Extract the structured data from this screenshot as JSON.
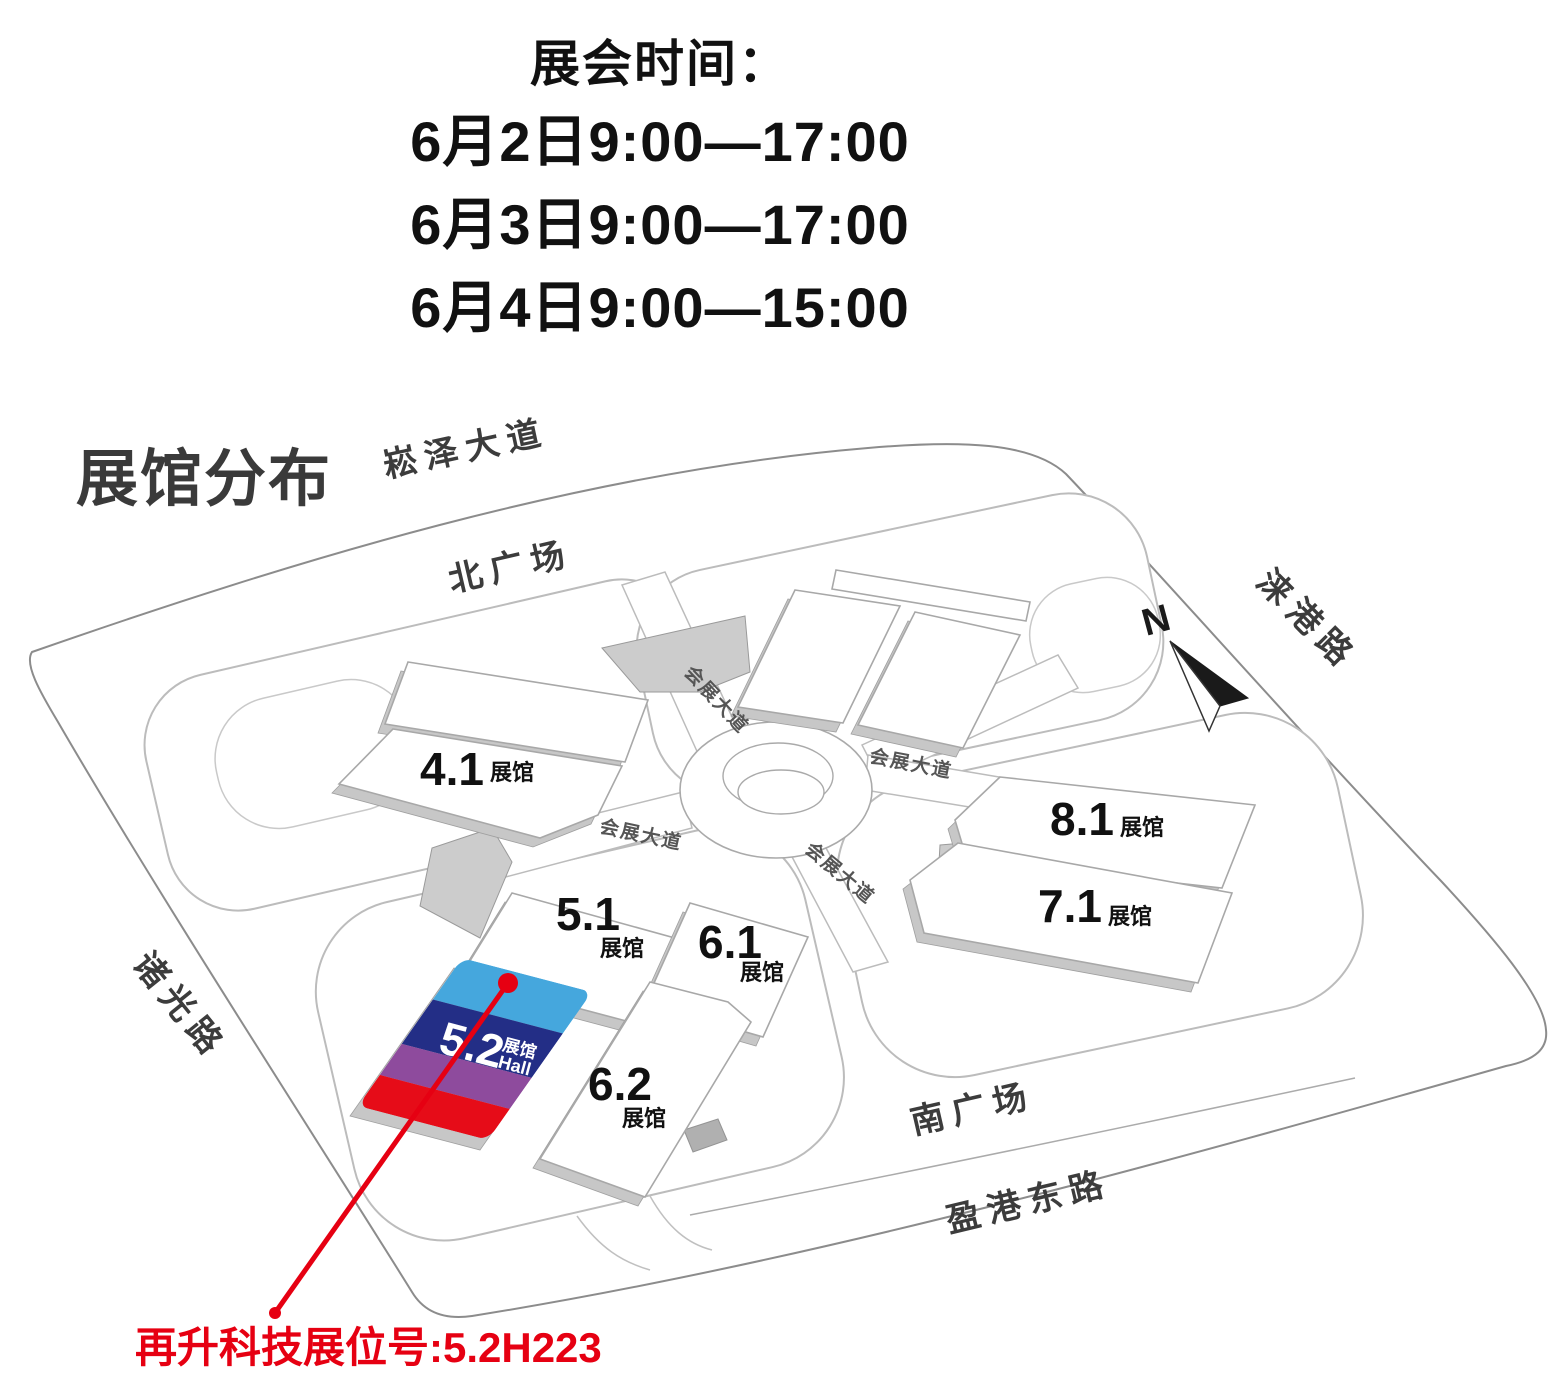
{
  "header": {
    "title": "展会时间：",
    "schedule": [
      "6月2日9:00—17:00",
      "6月3日9:00—17:00",
      "6月4日9:00—15:00"
    ]
  },
  "map": {
    "title": "展馆分布",
    "compass_label": "N",
    "roads": {
      "north_avenue": "崧泽大道",
      "north_plaza": "北广场",
      "exhibition_avenue": "会展大道",
      "east_road": "涞港路",
      "west_road": "诸光路",
      "south_plaza": "南广场",
      "south_road": "盈港东路"
    },
    "halls": [
      {
        "id": "4.1",
        "suffix": "展馆"
      },
      {
        "id": "5.1",
        "suffix": "展馆"
      },
      {
        "id": "6.1",
        "suffix": "展馆"
      },
      {
        "id": "6.2",
        "suffix": "展馆"
      },
      {
        "id": "7.1",
        "suffix": "展馆"
      },
      {
        "id": "8.1",
        "suffix": "展馆"
      }
    ],
    "highlight_hall": {
      "id": "5.2",
      "suffix": "展馆",
      "suffix_en": "Hall",
      "stripe_colors": [
        "#45a7dd",
        "#232e86",
        "#8e4b9d",
        "#e60c18"
      ]
    },
    "annotation": {
      "text": "再升科技展位号:5.2H223",
      "color": "#e60012"
    }
  }
}
